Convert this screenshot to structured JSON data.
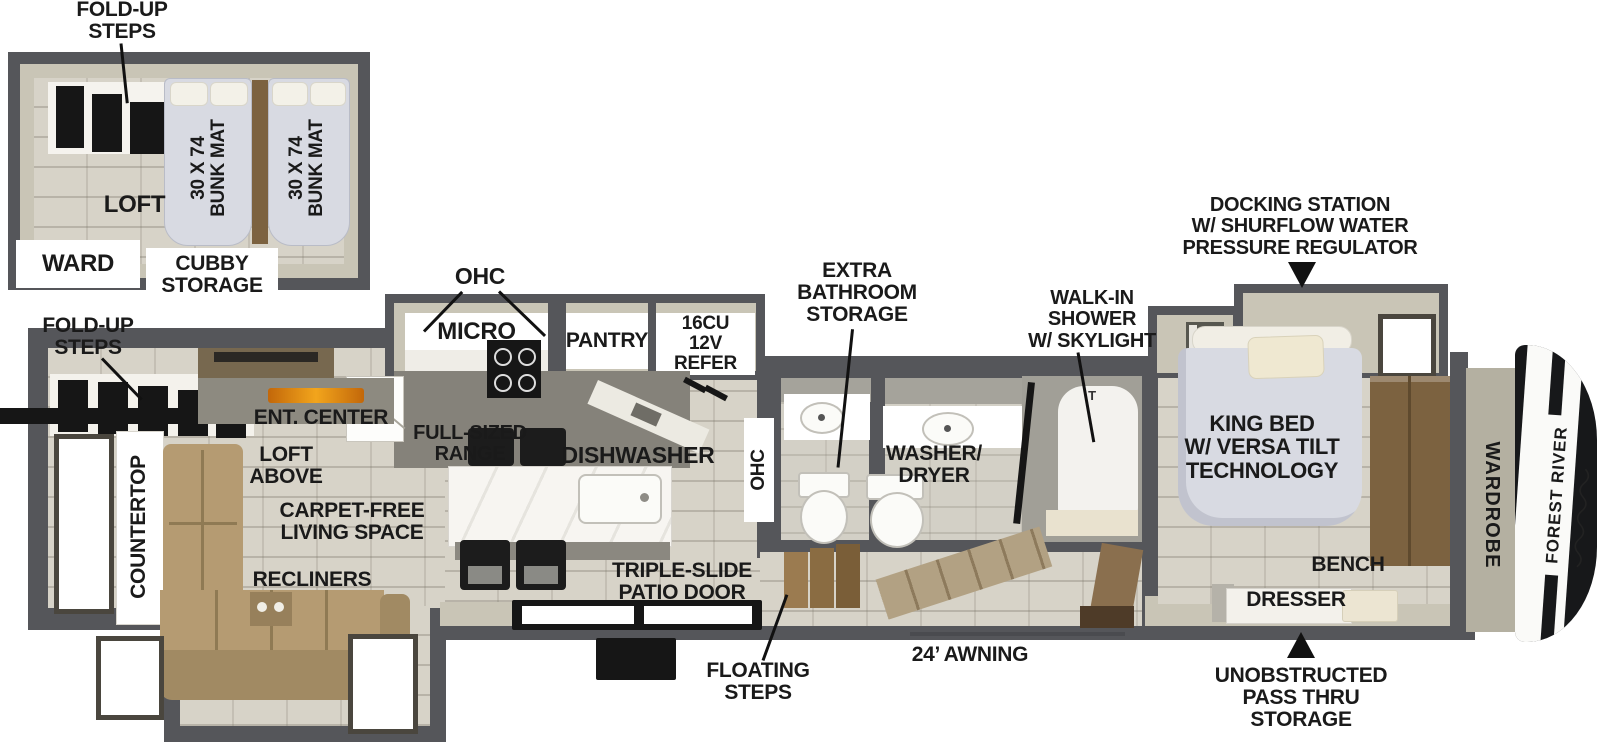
{
  "colors": {
    "wall": "#55565a",
    "wall_fill": "#c9c5b6",
    "floor": "#d7d3c8",
    "wood": "#7c6240",
    "sofa": "#b59b72",
    "fireplace": "#e8920f",
    "bed": "#d8dae2",
    "label": "#1a1a1a"
  },
  "brand": {
    "logo_text": "FOREST RIVER"
  },
  "loft_inset": {
    "fold_up_steps": "FOLD-UP\nSTEPS",
    "loft": "LOFT",
    "ward": "WARD",
    "cubby_storage": "CUBBY\nSTORAGE",
    "bunk_mats": [
      "30 X 74\nBUNK MAT",
      "30 X 74\nBUNK MAT"
    ]
  },
  "living": {
    "fold_up_steps": "FOLD-UP\nSTEPS",
    "ent_center": "ENT. CENTER",
    "loft_above": "LOFT\nABOVE",
    "carpet_free": "CARPET-FREE\nLIVING SPACE",
    "recliners": "RECLINERS",
    "countertop": "COUNTERTOP"
  },
  "kitchen": {
    "ohc": "OHC",
    "micro": "MICRO",
    "pantry": "PANTRY",
    "refer": "16CU\n12V REFER",
    "range": "FULL-SIZED\nRANGE",
    "dishwasher": "DISHWASHER",
    "ohc_side": "OHC"
  },
  "bath": {
    "extra_storage": "EXTRA\nBATHROOM\nSTORAGE",
    "washer_dryer": "WASHER/\nDRYER",
    "walk_in_shower": "WALK-IN\nSHOWER\nW/ SKYLIGHT",
    "shower_t": "T"
  },
  "bedroom": {
    "docking_station": "DOCKING STATION\nW/ SHURFLOW WATER\nPRESSURE REGULATOR",
    "king_bed": "KING BED\nW/ VERSA TILT\nTECHNOLOGY",
    "bench": "BENCH",
    "dresser": "DRESSER",
    "wardrobe": "WARDROBE"
  },
  "exterior": {
    "triple_slide_door": "TRIPLE-SLIDE\nPATIO DOOR",
    "floating_steps": "FLOATING\nSTEPS",
    "awning": "24’ AWNING",
    "pass_thru": "UNOBSTRUCTED\nPASS THRU\nSTORAGE"
  }
}
